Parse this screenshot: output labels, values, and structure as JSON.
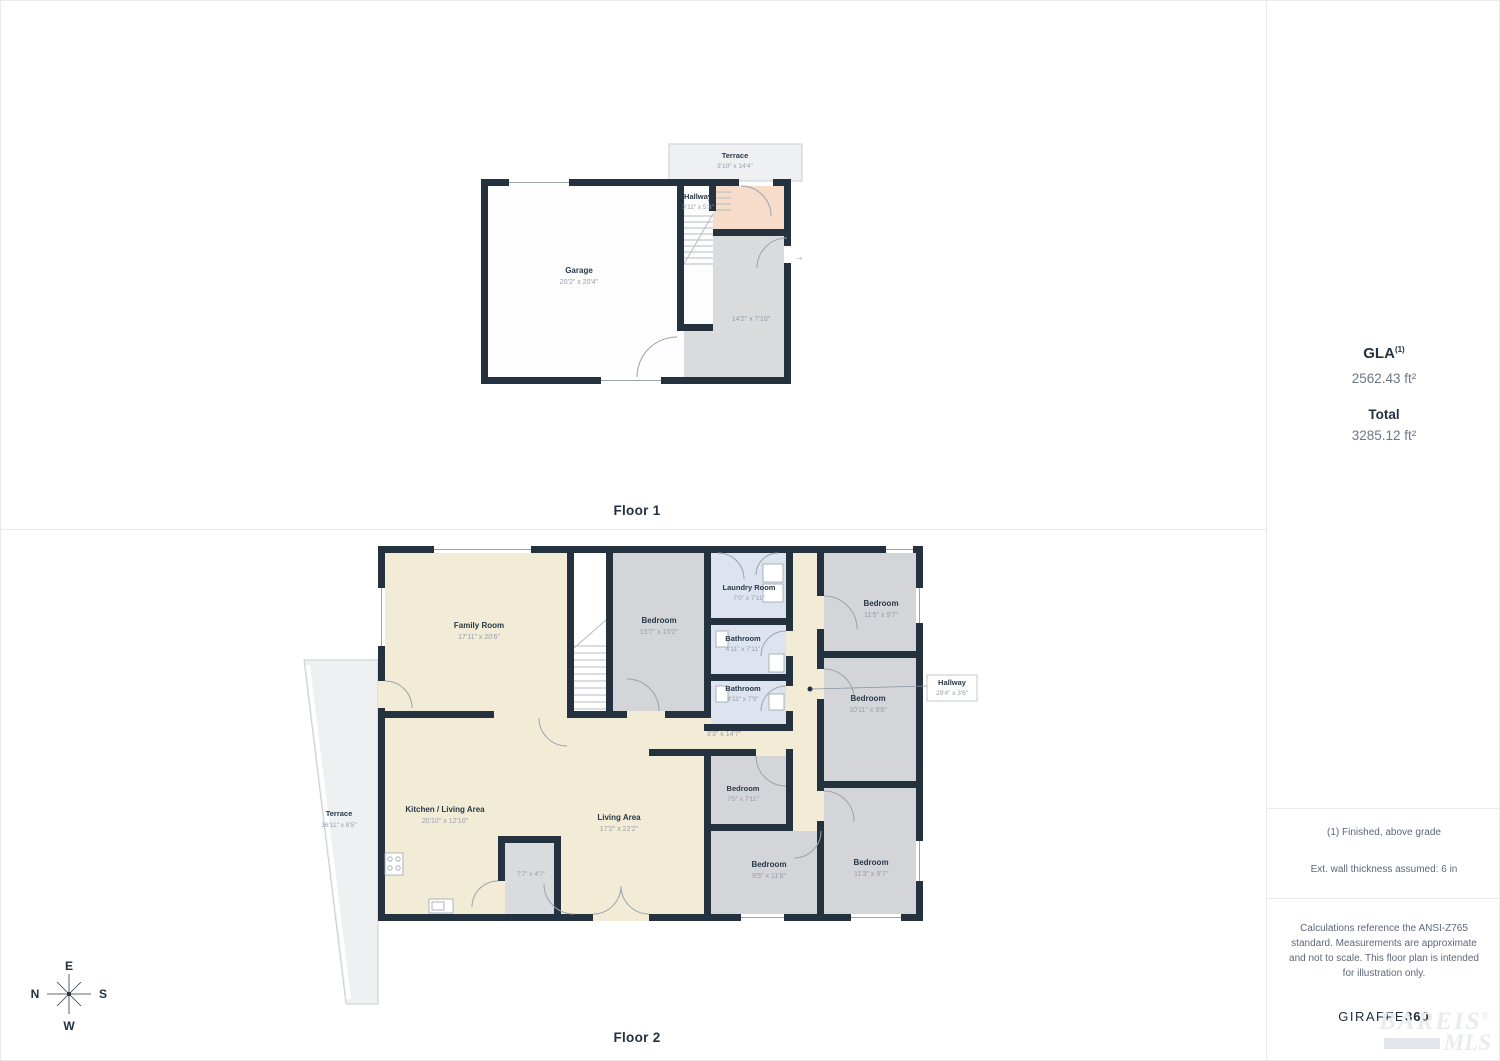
{
  "floor1": {
    "label": "Floor 1",
    "terrace": {
      "name": "Terrace",
      "dims": "3'10\" x 14'4\""
    },
    "hallway": {
      "name": "Hallway",
      "dims": "3'11\" x 5'3\""
    },
    "garage": {
      "name": "Garage",
      "dims": "20'2\" x 20'4\""
    },
    "side_room": {
      "dims": "14'2\" x 7'10\""
    },
    "entry_arrow": "→"
  },
  "floor2": {
    "label": "Floor 2",
    "family_room": {
      "name": "Family Room",
      "dims": "17'11\" x 20'6\""
    },
    "bedroom_a": {
      "name": "Bedroom",
      "dims": "15'7\" x 10'2\""
    },
    "laundry": {
      "name": "Laundry Room",
      "dims": "7'0\" x 7'11\""
    },
    "bathroom_a": {
      "name": "Bathroom",
      "dims": "4'11\" x 7'11\""
    },
    "bathroom_b": {
      "name": "Bathroom",
      "dims": "4'11\" x 7'9\""
    },
    "bedroom_b": {
      "name": "Bedroom",
      "dims": "11'5\" x 9'7\""
    },
    "bedroom_c": {
      "name": "Bedroom",
      "dims": "10'11\" x 9'6\""
    },
    "hallway_callout": {
      "name": "Hallway",
      "dims": "29'4\" x 3'6\""
    },
    "corridor_dims": "3'3\" x 14'7\"",
    "kitchen": {
      "name": "Kitchen / Living Area",
      "dims": "20'10\" x 12'10\""
    },
    "living": {
      "name": "Living Area",
      "dims": "17'2\" x 22'2\""
    },
    "closet_dims": "7'7\" x 4'7\"",
    "bedroom_d": {
      "name": "Bedroom",
      "dims": "7'5\" x 7'11\""
    },
    "bedroom_e": {
      "name": "Bedroom",
      "dims": "9'5\" x 11'8\""
    },
    "bedroom_f": {
      "name": "Bedroom",
      "dims": "11'3\" x 9'7\""
    },
    "terrace": {
      "name": "Terrace",
      "dims": "36'11\" x 8'5\""
    }
  },
  "sidebar": {
    "gla_label": "GLA",
    "gla_sup": "(1)",
    "gla_value": "2562.43 ft²",
    "total_label": "Total",
    "total_value": "3285.12 ft²",
    "note_finished": "(1) Finished, above grade",
    "note_wall": "Ext. wall thickness assumed: 6 in",
    "disclaimer": "Calculations reference the ANSI-Z765 standard. Measurements are approximate and not to scale. This floor plan is intended for illustration only.",
    "brand_name": "GIRAFFE",
    "brand_number": "360"
  },
  "compass": {
    "top": "E",
    "left": "N",
    "right": "S",
    "bottom": "W"
  },
  "watermark": {
    "line1": "BAREIS",
    "reg": "®",
    "line2": "MLS"
  },
  "colors": {
    "wall": "#24313f",
    "cream": "#f2ecd7",
    "gray_room": "#d3d5d8",
    "blue_room": "#dde4f0",
    "salmon": "#f6dcc9",
    "terrace": "#eef0f1"
  }
}
